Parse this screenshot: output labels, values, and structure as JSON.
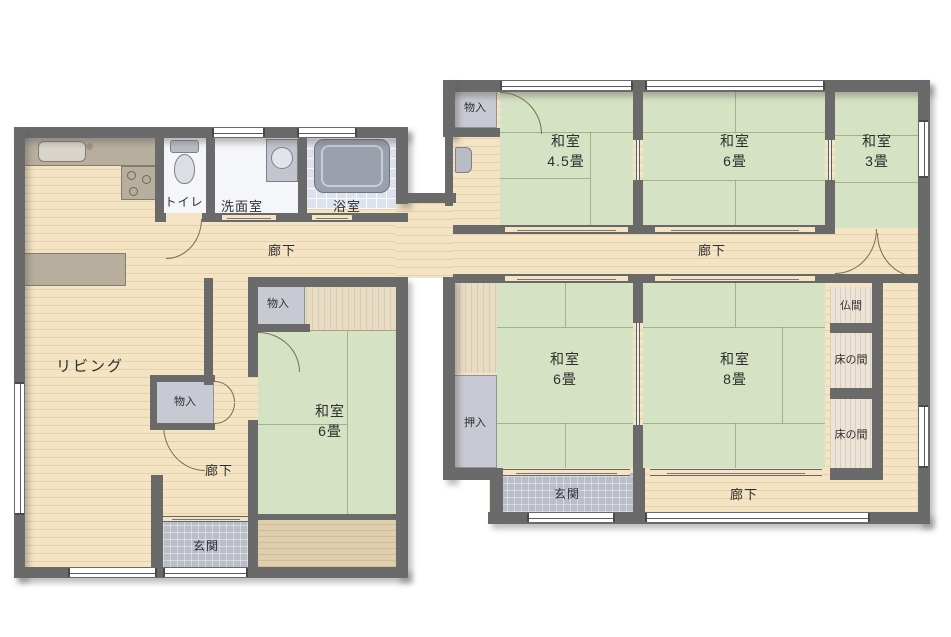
{
  "labels": {
    "living": "リビング",
    "toilet": "トイレ",
    "washroom": "洗面室",
    "bathroom": "浴室",
    "hallway": "廊下",
    "entrance": "玄関",
    "storage": "物入",
    "closet": "押入",
    "buddhist_alcove": "仏間",
    "tokonoma": "床の間",
    "japanese_room": "和室",
    "size_4_5_tatami": "4.5畳",
    "size_6_tatami": "6畳",
    "size_3_tatami": "3畳",
    "size_8_tatami": "8畳"
  },
  "colors": {
    "wall": "#6a6a6a",
    "wood_floor": "#f4e4c3",
    "tatami": "#d6e2c4",
    "entrance_tile": "#b9bec9",
    "closet_fill": "#c7cad2",
    "bathroom_floor": "#dde3ee",
    "counter": "#b7ae9e",
    "background": "#ffffff"
  }
}
